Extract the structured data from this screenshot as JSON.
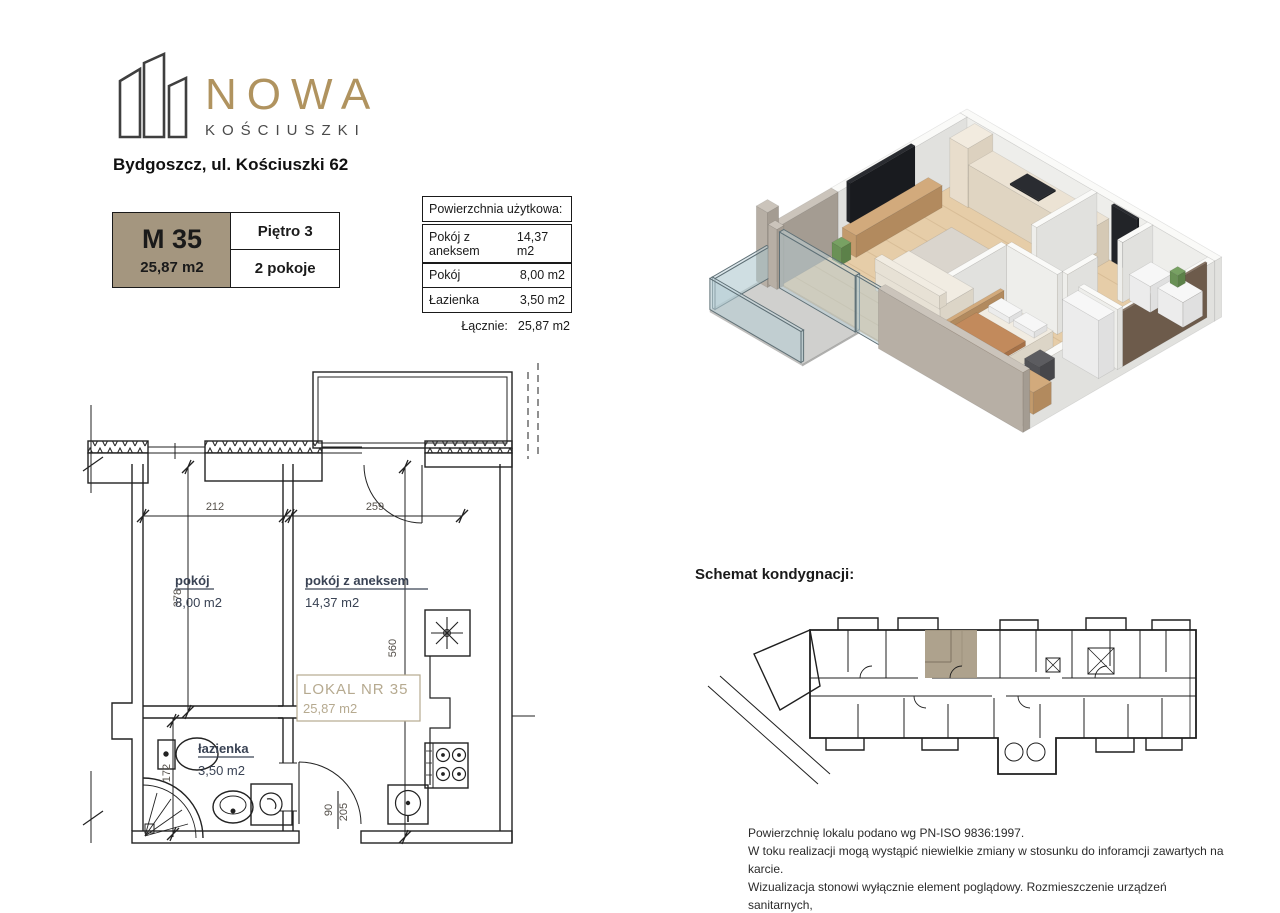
{
  "logo": {
    "name": "NOWA",
    "sub": "KOŚCIUSZKI"
  },
  "address": "Bydgoszcz, ul. Kościuszki 62",
  "card": {
    "unit": "M 35",
    "area": "25,87 m2",
    "floor": "Piętro 3",
    "rooms": "2 pokoje"
  },
  "table": {
    "title": "Powierzchnia użytkowa:",
    "rows": [
      [
        "Pokój z aneksem",
        "14,37 m2"
      ],
      [
        "Pokój",
        "8,00 m2"
      ],
      [
        "Łazienka",
        "3,50 m2"
      ]
    ],
    "total_label": "Łącznie:",
    "total": "25,87 m2"
  },
  "plan": {
    "room1": {
      "name": "pokój",
      "area": "8,00 m2"
    },
    "room2": {
      "name": "pokój z aneksem",
      "area": "14,37 m2"
    },
    "room3": {
      "name": "łazienka",
      "area": "3,50 m2"
    },
    "lokal": {
      "name": "LOKAL NR 35",
      "area": "25,87 m2"
    },
    "dims": {
      "w1": "212",
      "w2": "259",
      "h1": "378",
      "h2": "560",
      "bath": "172",
      "d1": "90",
      "d2": "205"
    }
  },
  "schemat_title": "Schemat kondygnacji:",
  "disclaimer": [
    "Powierzchnię lokalu podano wg PN-ISO 9836:1997.",
    "W toku realizacji mogą wystąpić niewielkie zmiany w stosunku do inforamcji zawartych na karcie.",
    "Wizualizacja stonowi wyłącznie element poglądowy. Rozmieszczenie urządzeń sanitarnych,",
    "kuchennych oraz mebli przedstawione jest jako przykładowe."
  ],
  "colors": {
    "accent_tan": "#a4967f",
    "gold": "#b0935f",
    "lokal_tan": "#b6aa90",
    "highlight_unit": "#a89b84"
  }
}
